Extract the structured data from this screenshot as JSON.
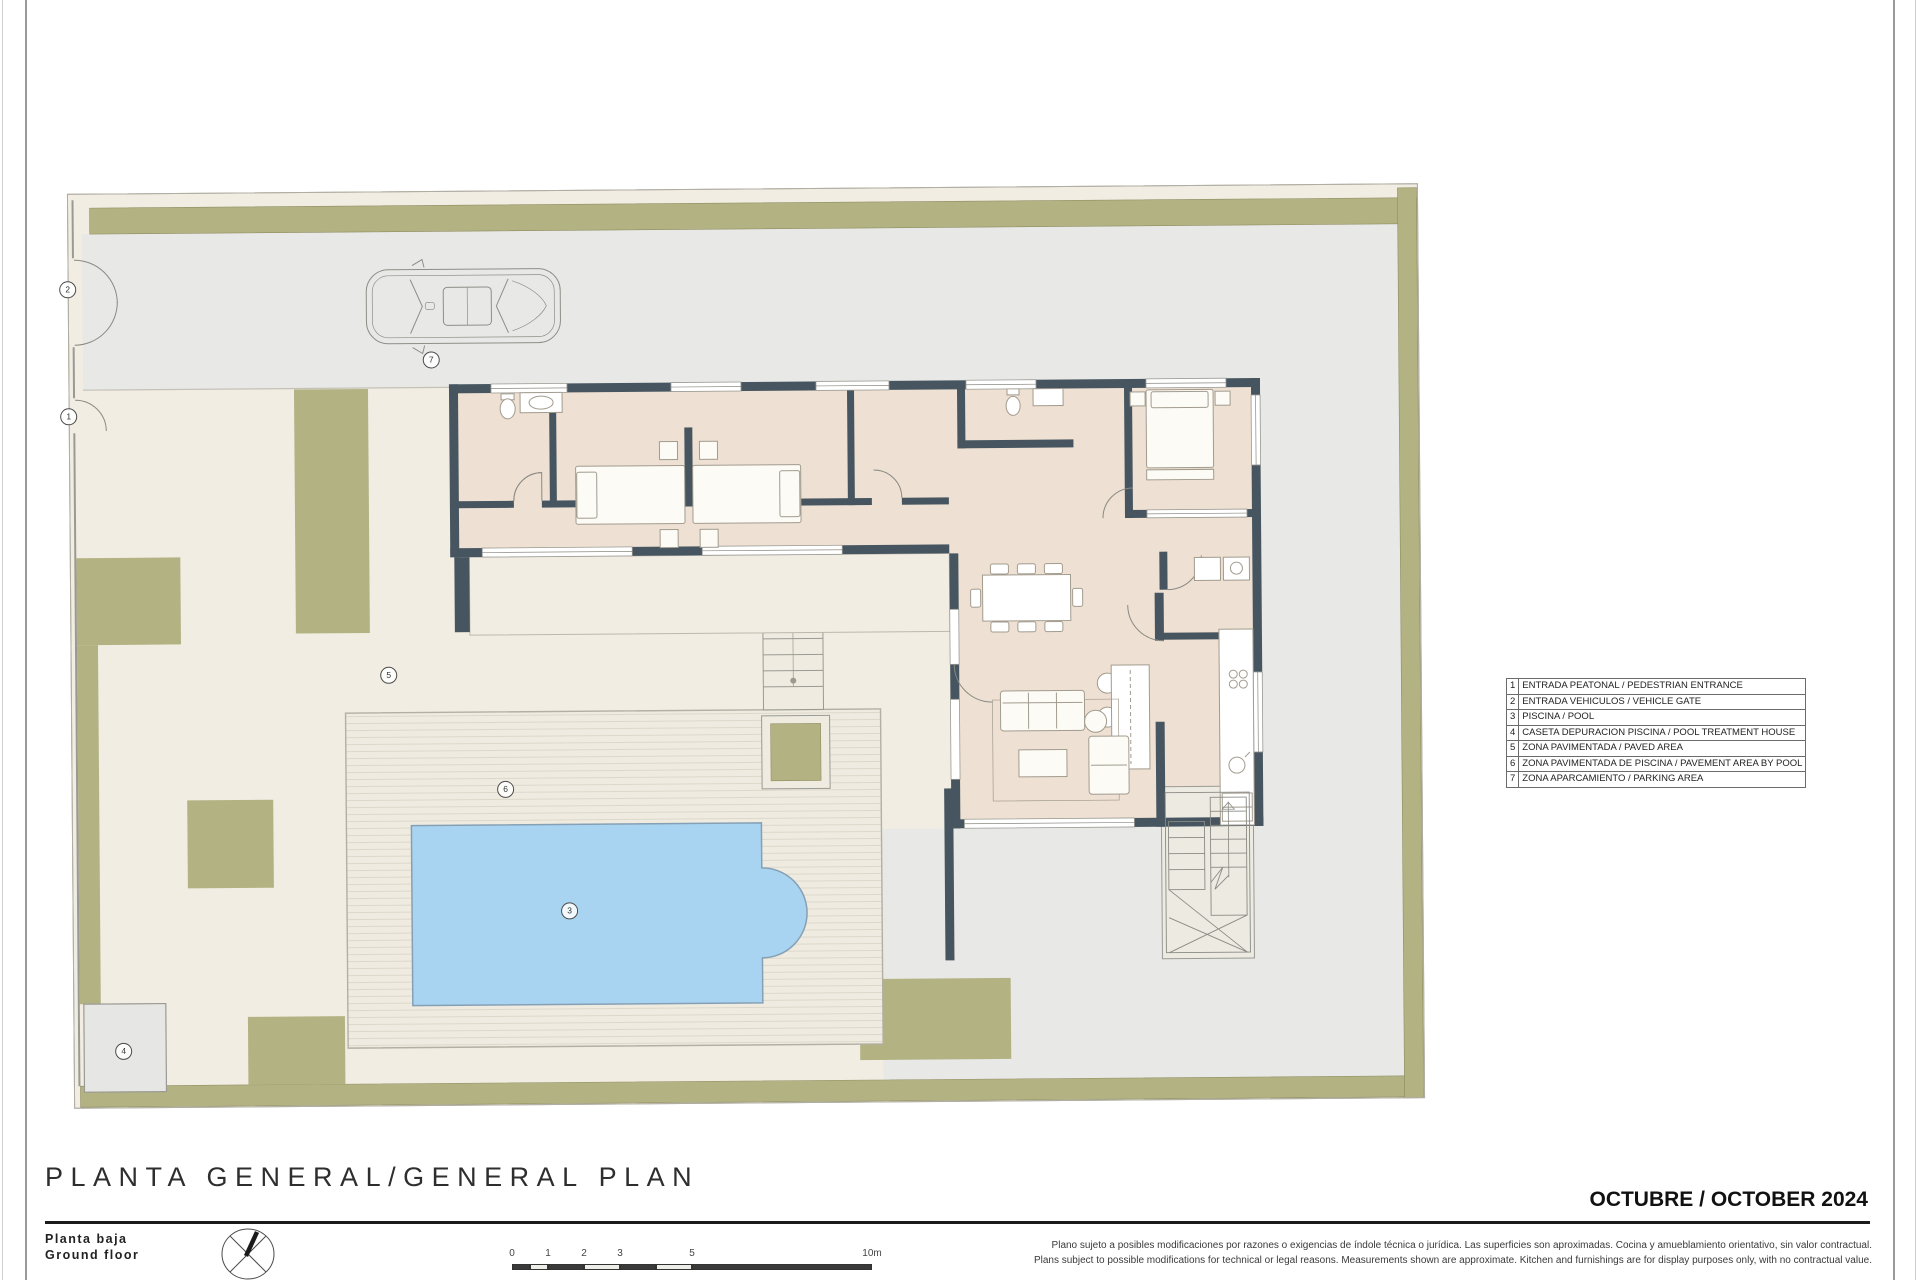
{
  "sheet": {
    "title": "PLANTA GENERAL/GENERAL PLAN",
    "floor_label_es": "Planta baja",
    "floor_label_en": "Ground floor",
    "date": "OCTUBRE / OCTOBER 2024",
    "disclaimer_es": "Plano sujeto a posibles modificaciones por razones o exigencias de índole técnica o jurídica. Las superficies son aproximadas. Cocina y amueblamiento orientativo, sin valor contractual.",
    "disclaimer_en": "Plans subject to possible modifications for technical or legal reasons. Measurements shown are approximate. Kitchen and furnishings are for display purposes only, with no contractual value."
  },
  "legend": {
    "items": [
      {
        "num": "1",
        "label": "ENTRADA PEATONAL / PEDESTRIAN ENTRANCE"
      },
      {
        "num": "2",
        "label": "ENTRADA VEHICULOS / VEHICLE GATE"
      },
      {
        "num": "3",
        "label": "PISCINA / POOL"
      },
      {
        "num": "4",
        "label": "CASETA DEPURACION PISCINA / POOL TREATMENT HOUSE"
      },
      {
        "num": "5",
        "label": "ZONA PAVIMENTADA / PAVED AREA"
      },
      {
        "num": "6",
        "label": "ZONA PAVIMENTADA DE PISCINA / PAVEMENT AREA BY POOL"
      },
      {
        "num": "7",
        "label": "ZONA APARCAMIENTO / PARKING AREA"
      }
    ]
  },
  "markers": [
    {
      "num": "1",
      "x": 7,
      "y": 230
    },
    {
      "num": "2",
      "x": 7,
      "y": 103
    },
    {
      "num": "3",
      "x": 504,
      "y": 728
    },
    {
      "num": "4",
      "x": 57,
      "y": 865
    },
    {
      "num": "5",
      "x": 325,
      "y": 491
    },
    {
      "num": "6",
      "x": 441,
      "y": 606
    },
    {
      "num": "7",
      "x": 370,
      "y": 176
    }
  ],
  "scale_bar": {
    "labels": [
      {
        "text": "0",
        "m": 0
      },
      {
        "text": "1",
        "m": 1
      },
      {
        "text": "2",
        "m": 2
      },
      {
        "text": "3",
        "m": 3
      },
      {
        "text": "5",
        "m": 5
      },
      {
        "text": "10m",
        "m": 10
      }
    ]
  },
  "colors": {
    "olive": "#b3b283",
    "driveway": "#e8e8e6",
    "paved": "#f1ede2",
    "deck": "#efebe0",
    "deck_stripe": "#dcd8ca",
    "interior": "#eee0d2",
    "wall": "#46555f",
    "pool": "#a9d4f1",
    "pool_edge": "#85a0b5"
  }
}
